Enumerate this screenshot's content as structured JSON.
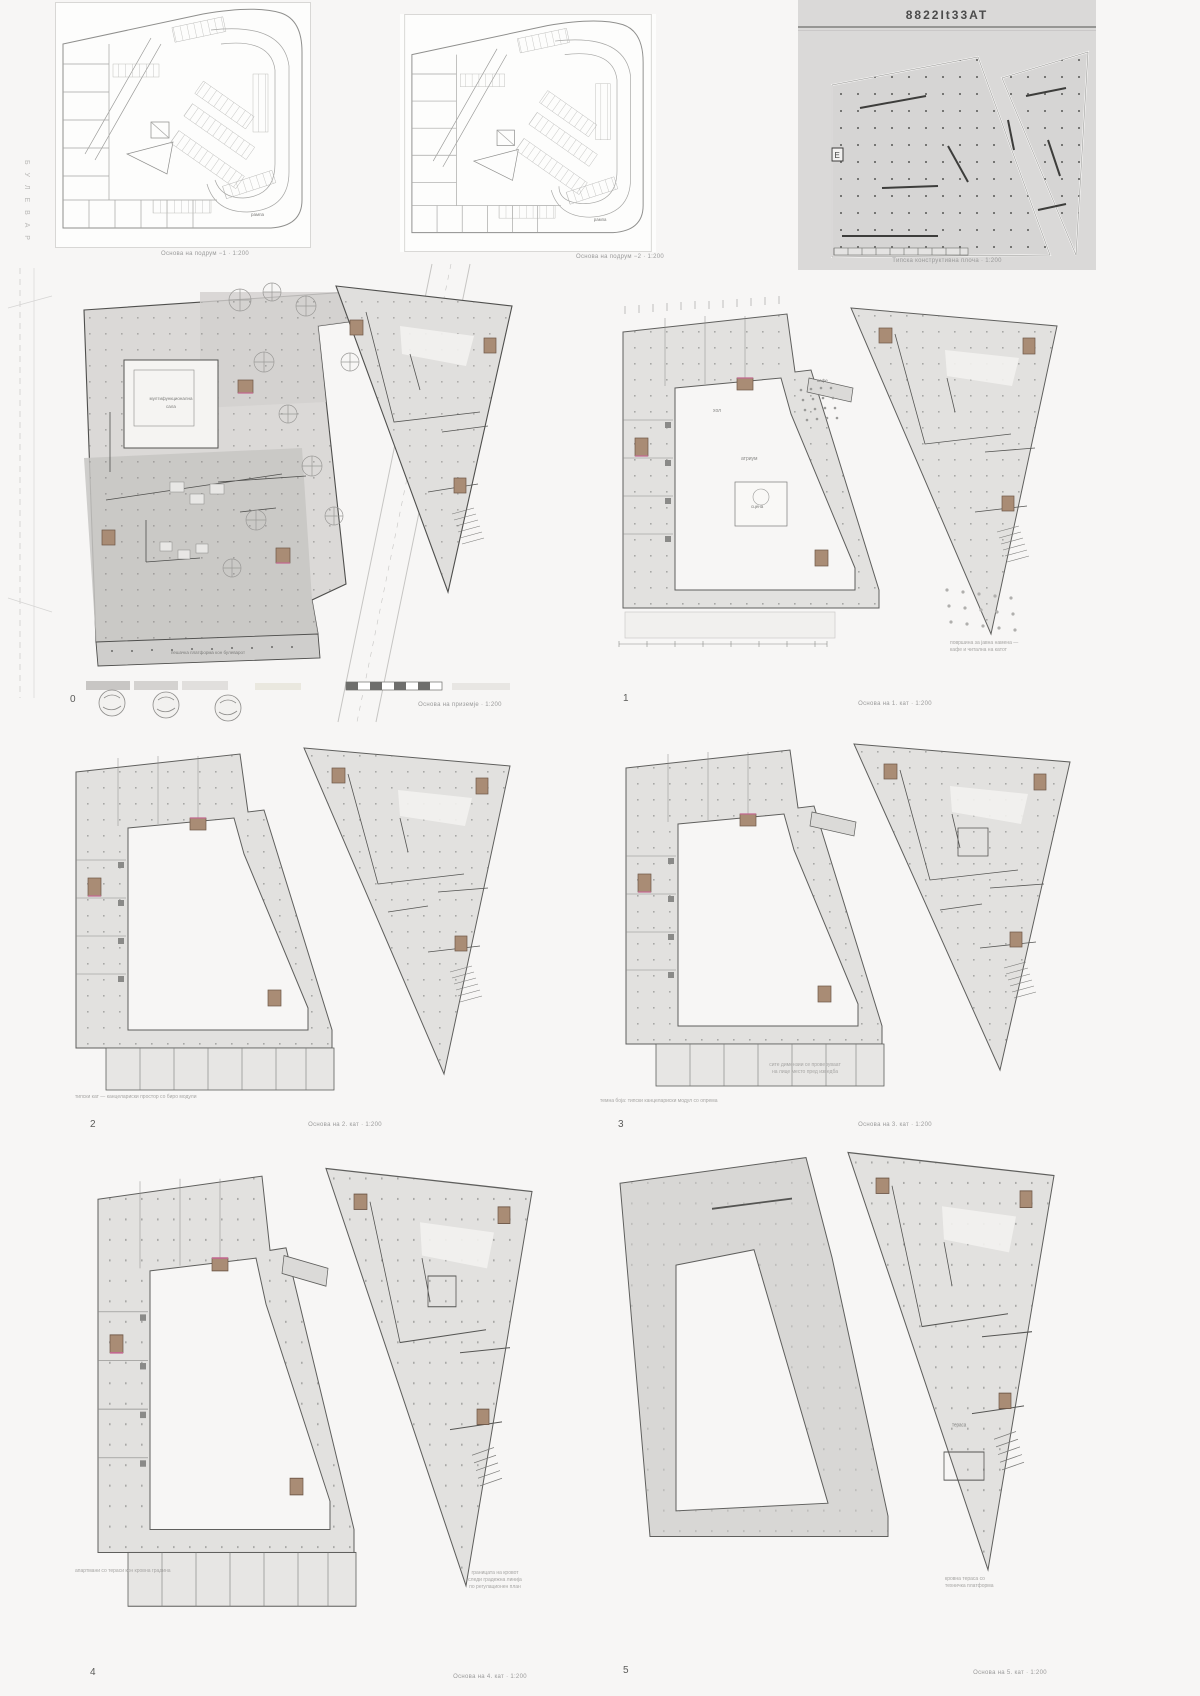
{
  "colors": {
    "page_bg": "#f7f6f5",
    "panel_gray": "#dad9d8",
    "floor_fill": "#e2e1df",
    "floor_dark": "#c7c5c3",
    "core_brown": "#a98c75",
    "accent_pink": "#c2688f",
    "line_dark": "#4f4f4d",
    "caption_gray": "#9a9a9a"
  },
  "titleblock": {
    "code": "8822It33AT",
    "caption": "Типска конструктивна плоча · 1:200",
    "grid_marker": "E"
  },
  "basements": {
    "b1": {
      "caption": "Основа на подрум −1 · 1:200",
      "ramp_label": "рампа"
    },
    "b2": {
      "caption": "Основа на подрум −2 · 1:200",
      "ramp_label": "рампа"
    }
  },
  "street_label": "Б У Л Е В А Р",
  "floor0": {
    "num": "0",
    "caption": "Основа на приземје · 1:200",
    "hall_label_1": "мултифункционална",
    "hall_label_2": "сала",
    "terrace_label": "пешачка платформа кон булеварот"
  },
  "floor1": {
    "num": "1",
    "caption": "Основа на 1. кат · 1:200",
    "hall": "хол",
    "atrium": "атриум",
    "stage": "сцена",
    "cafe": "кафе",
    "note_1": "површина за јавна намена —",
    "note_2": "кафе и читална на катот"
  },
  "floor2": {
    "num": "2",
    "caption": "Основа на 2. кат · 1:200",
    "note": "типски кат — канцелариски простор со биро модули"
  },
  "floor3": {
    "num": "3",
    "caption": "Основа на 3. кат · 1:200",
    "note": "темна боја: типски канцелариски модул со опрема",
    "note2_1": "сите димензии се проверуваат",
    "note2_2": "на лице место пред изведба"
  },
  "floor4": {
    "num": "4",
    "caption": "Основа на 4. кат · 1:200",
    "note": "апартмани со тераси кон кровна градина",
    "note2_1": "границата на кровот",
    "note2_2": "следи градежна линија",
    "note2_3": "по регулационен план"
  },
  "floor5": {
    "num": "5",
    "caption": "Основа на 5. кат · 1:200",
    "note_1": "кровна тераса со",
    "note_2": "техничка платформа",
    "terrace": "тераса"
  }
}
